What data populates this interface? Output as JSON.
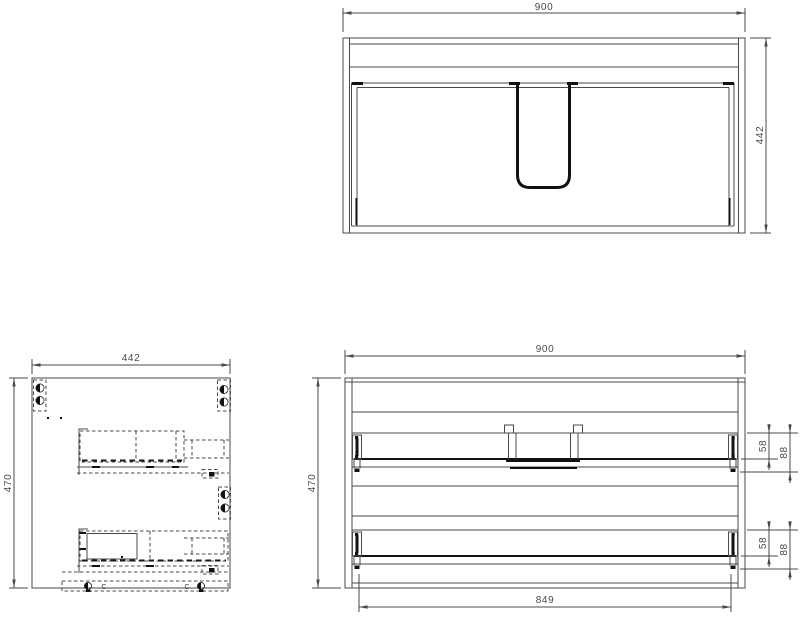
{
  "drawing": {
    "colors": {
      "line": "#4a4a4a",
      "accent": "#111111",
      "background": "#ffffff"
    },
    "top_view": {
      "width": "900",
      "depth": "442"
    },
    "side_view": {
      "width": "442",
      "height": "470",
      "clip_marks": [
        "C",
        "C"
      ]
    },
    "back_view": {
      "width": "900",
      "height": "470",
      "drawer_width": "849",
      "top_drawer": {
        "rail_offset": "58",
        "rail_height": "88"
      },
      "bottom_drawer": {
        "rail_offset": "58",
        "rail_height": "88"
      }
    }
  }
}
